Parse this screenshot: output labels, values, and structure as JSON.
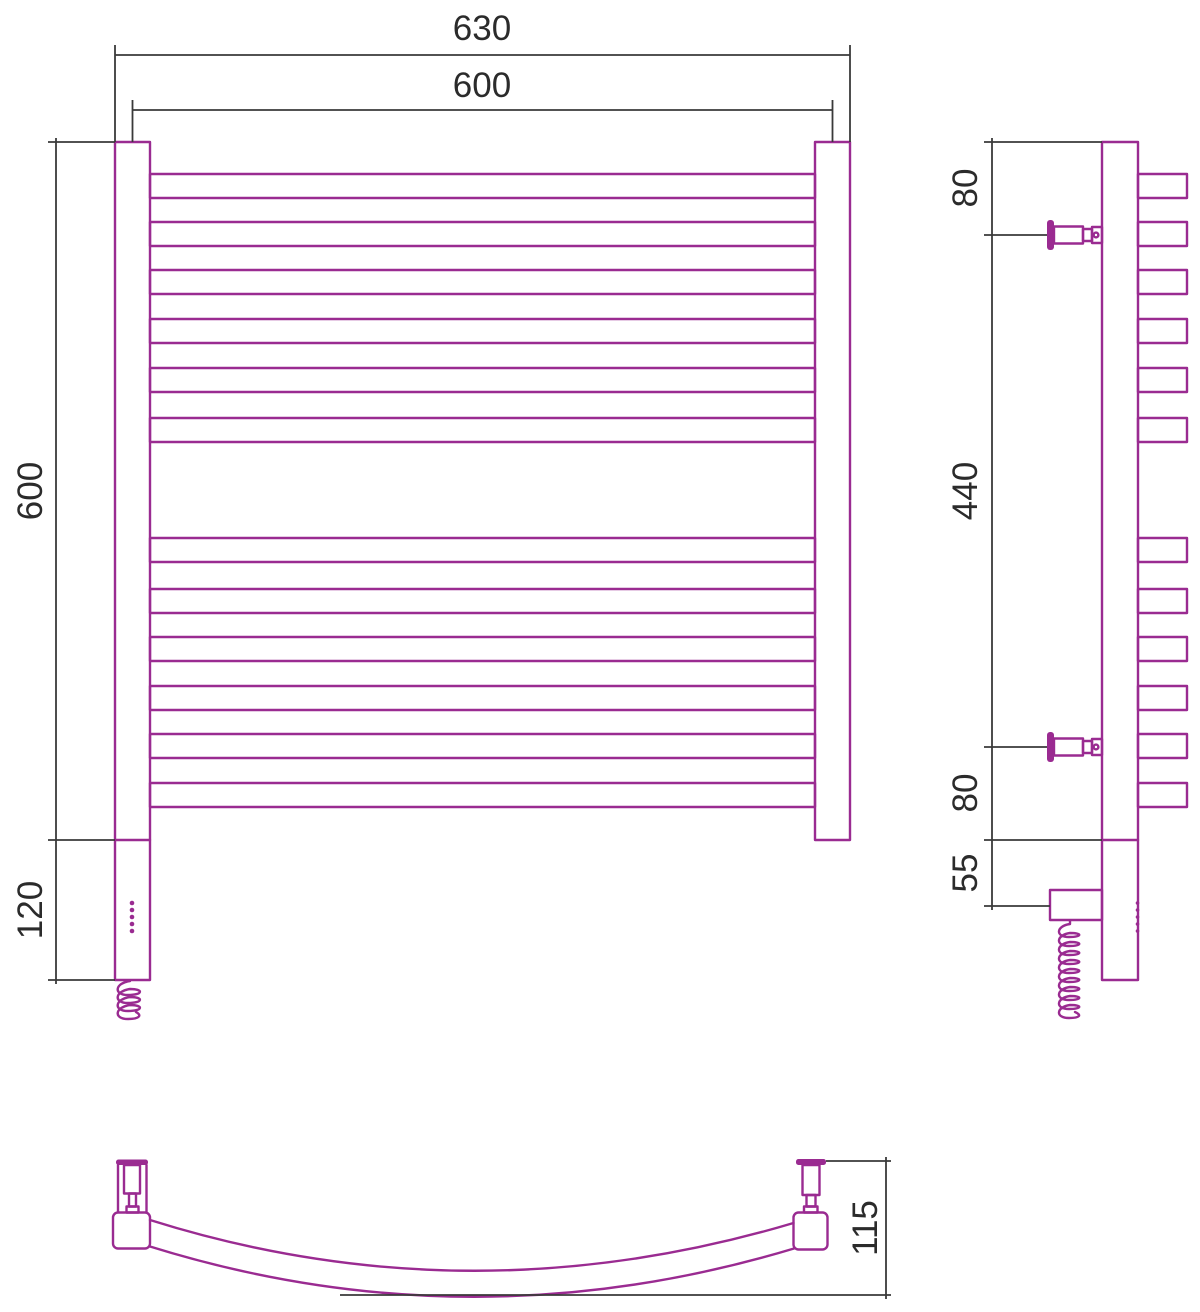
{
  "drawing_title": "curved electric towel rail technical drawing, three orthographic views",
  "colors": {
    "product": "#9A2B91",
    "dimension_lines": "#3a3a3a",
    "dimension_text": "#2b2b2b"
  },
  "front_view": {
    "outer_width": "630",
    "rail_center_width": "600",
    "body_height": "600",
    "heater_section_height": "120"
  },
  "side_view": {
    "top_to_bracket": "80",
    "bracket_span": "440",
    "bracket_to_bottom": "80",
    "cable_outlet_offset": "55"
  },
  "bottom_view": {
    "arc_depth": "115"
  }
}
